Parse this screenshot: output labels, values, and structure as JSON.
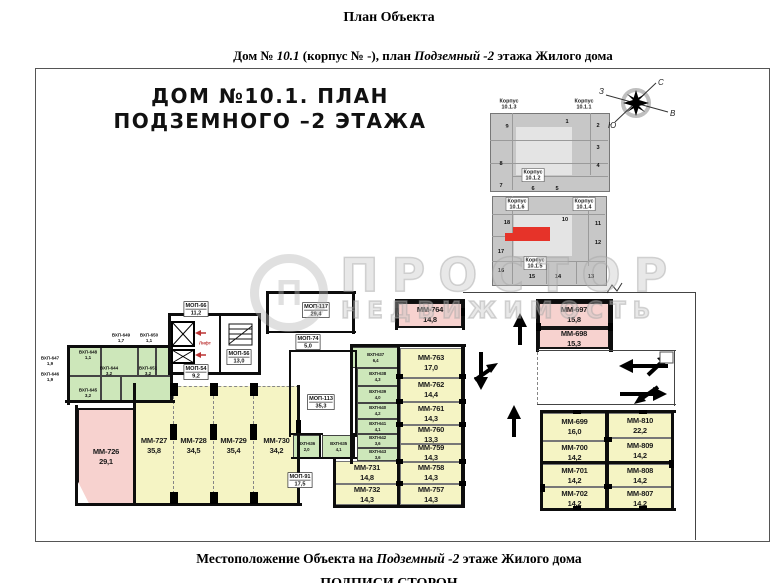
{
  "page": {
    "title": "План Объекта",
    "subtitle_parts": [
      {
        "t": "Дом № ",
        "i": false
      },
      {
        "t": "10.1",
        "i": true
      },
      {
        "t": " (корпус № -), план ",
        "i": false
      },
      {
        "t": "Подземный -2",
        "i": true
      },
      {
        "t": " этажа Жилого дома",
        "i": false
      }
    ],
    "footer_parts": [
      {
        "t": "Местоположение Объекта на  ",
        "i": false
      },
      {
        "t": "Подземный -2",
        "i": true
      },
      {
        "t": " этаже Жилого дома",
        "i": false
      }
    ],
    "footer_signatures": "ПОДПИСИ СТОРОН"
  },
  "plan_title": {
    "line1": "ДОМ №10.1. ПЛАН",
    "line2": "ПОДЗЕМНОГО –2 ЭТАЖА"
  },
  "watermark": {
    "logo_letter": "П",
    "line1": "ПРОСТОР",
    "line2": "НЕДВИЖИМОСТЬ"
  },
  "compass": {
    "north": "С",
    "south": "Ю",
    "west": "З",
    "east": "В"
  },
  "lift": {
    "label": "Лифт",
    "color": "#b33"
  },
  "keyplan": {
    "highlight_color": "#e63329",
    "korpus_labels": [
      {
        "name": "Корпус",
        "num": "10.1.3",
        "x": 509,
        "y": 104,
        "boxed": false
      },
      {
        "name": "Корпус",
        "num": "10.1.1",
        "x": 584,
        "y": 104,
        "boxed": false
      },
      {
        "name": "Корпус",
        "num": "10.1.2",
        "x": 533,
        "y": 175,
        "boxed": true
      },
      {
        "name": "Корпус",
        "num": "10.1.6",
        "x": 517,
        "y": 204,
        "boxed": true
      },
      {
        "name": "Корпус",
        "num": "10.1.4",
        "x": 584,
        "y": 204,
        "boxed": true
      },
      {
        "name": "Корпус",
        "num": "10.1.5",
        "x": 535,
        "y": 263,
        "boxed": true
      }
    ],
    "sections": [
      {
        "n": "9",
        "x": 507,
        "y": 126
      },
      {
        "n": "1",
        "x": 567,
        "y": 121
      },
      {
        "n": "2",
        "x": 598,
        "y": 125
      },
      {
        "n": "3",
        "x": 598,
        "y": 147
      },
      {
        "n": "8",
        "x": 501,
        "y": 163
      },
      {
        "n": "4",
        "x": 598,
        "y": 165
      },
      {
        "n": "7",
        "x": 501,
        "y": 185
      },
      {
        "n": "6",
        "x": 533,
        "y": 188
      },
      {
        "n": "5",
        "x": 557,
        "y": 188
      },
      {
        "n": "18",
        "x": 507,
        "y": 222
      },
      {
        "n": "10",
        "x": 565,
        "y": 219
      },
      {
        "n": "11",
        "x": 598,
        "y": 223
      },
      {
        "n": "12",
        "x": 598,
        "y": 242
      },
      {
        "n": "17",
        "x": 501,
        "y": 251
      },
      {
        "n": "16",
        "x": 501,
        "y": 270
      },
      {
        "n": "15",
        "x": 532,
        "y": 276
      },
      {
        "n": "14",
        "x": 558,
        "y": 276
      },
      {
        "n": "13",
        "x": 591,
        "y": 276
      }
    ]
  },
  "rooms": [
    {
      "id": "ММ-726",
      "area": "29,1",
      "type": "pink",
      "x": 77,
      "y": 408,
      "w": 58,
      "h": 97,
      "clip": true
    },
    {
      "id": "ММ-727",
      "area": "35,8",
      "type": "yellow",
      "x": 135,
      "y": 386,
      "w": 38,
      "h": 118,
      "bay": true
    },
    {
      "id": "ММ-728",
      "area": "34,5",
      "type": "yellow",
      "x": 173,
      "y": 386,
      "w": 40,
      "h": 118,
      "bay": true,
      "dashLeft": true
    },
    {
      "id": "ММ-729",
      "area": "35,4",
      "type": "yellow",
      "x": 213,
      "y": 386,
      "w": 40,
      "h": 118,
      "bay": true,
      "dashLeft": true
    },
    {
      "id": "ММ-730",
      "area": "34,2",
      "type": "yellow",
      "x": 253,
      "y": 386,
      "w": 46,
      "h": 118,
      "bay": true,
      "dashLeft": true
    },
    {
      "id": "ММ-731",
      "area": "14,8",
      "type": "yellow",
      "x": 335,
      "y": 461,
      "w": 64,
      "h": 23
    },
    {
      "id": "ММ-732",
      "area": "14,3",
      "type": "yellow",
      "x": 335,
      "y": 484,
      "w": 64,
      "h": 21
    },
    {
      "id": "ММ-763",
      "area": "17,0",
      "type": "yellow",
      "x": 400,
      "y": 348,
      "w": 62,
      "h": 30
    },
    {
      "id": "ММ-762",
      "area": "14,4",
      "type": "yellow",
      "x": 400,
      "y": 378,
      "w": 62,
      "h": 24
    },
    {
      "id": "ММ-761",
      "area": "14,3",
      "type": "yellow",
      "x": 400,
      "y": 402,
      "w": 62,
      "h": 23
    },
    {
      "id": "ММ-760",
      "area": "13,3",
      "type": "yellow",
      "x": 400,
      "y": 425,
      "w": 62,
      "h": 19
    },
    {
      "id": "ММ-759",
      "area": "14,3",
      "type": "yellow",
      "x": 400,
      "y": 444,
      "w": 62,
      "h": 18
    },
    {
      "id": "ММ-758",
      "area": "14,3",
      "type": "yellow",
      "x": 400,
      "y": 462,
      "w": 62,
      "h": 22
    },
    {
      "id": "ММ-757",
      "area": "14,3",
      "type": "yellow",
      "x": 400,
      "y": 484,
      "w": 62,
      "h": 21
    },
    {
      "id": "ММ-764",
      "area": "14,8",
      "type": "pink",
      "x": 397,
      "y": 302,
      "w": 66,
      "h": 26
    },
    {
      "id": "ММ-697",
      "area": "15,8",
      "type": "pink",
      "x": 538,
      "y": 302,
      "w": 72,
      "h": 26
    },
    {
      "id": "ММ-698",
      "area": "15,3",
      "type": "pink",
      "x": 538,
      "y": 328,
      "w": 72,
      "h": 21
    },
    {
      "id": "ММ-699",
      "area": "16,0",
      "type": "yellow",
      "x": 542,
      "y": 413,
      "w": 65,
      "h": 28
    },
    {
      "id": "ММ-700",
      "area": "14,2",
      "type": "yellow",
      "x": 542,
      "y": 441,
      "w": 65,
      "h": 23
    },
    {
      "id": "ММ-701",
      "area": "14,2",
      "type": "yellow",
      "x": 542,
      "y": 464,
      "w": 65,
      "h": 23
    },
    {
      "id": "ММ-702",
      "area": "14,2",
      "type": "yellow",
      "x": 542,
      "y": 487,
      "w": 65,
      "h": 23
    },
    {
      "id": "ММ-810",
      "area": "22,2",
      "type": "yellow",
      "x": 607,
      "y": 413,
      "w": 66,
      "h": 25
    },
    {
      "id": "ММ-809",
      "area": "14,2",
      "type": "yellow",
      "x": 607,
      "y": 438,
      "w": 66,
      "h": 26
    },
    {
      "id": "ММ-808",
      "area": "14,2",
      "type": "yellow",
      "x": 607,
      "y": 464,
      "w": 66,
      "h": 23
    },
    {
      "id": "ММ-807",
      "area": "14,2",
      "type": "yellow",
      "x": 607,
      "y": 487,
      "w": 66,
      "h": 23
    },
    {
      "id": "ВХП-637",
      "area": "6,4",
      "type": "green",
      "x": 352,
      "y": 347,
      "w": 47,
      "h": 21,
      "small": true
    },
    {
      "id": "ВХП-638",
      "area": "4,3",
      "type": "green",
      "x": 357,
      "y": 368,
      "w": 42,
      "h": 18,
      "small": true
    },
    {
      "id": "ВХП-639",
      "area": "4,0",
      "type": "green",
      "x": 357,
      "y": 386,
      "w": 42,
      "h": 17,
      "small": true
    },
    {
      "id": "ВХП-640",
      "area": "4,2",
      "type": "green",
      "x": 357,
      "y": 403,
      "w": 42,
      "h": 16,
      "small": true
    },
    {
      "id": "ВХП-641",
      "area": "4,1",
      "type": "green",
      "x": 357,
      "y": 419,
      "w": 42,
      "h": 15,
      "small": true
    },
    {
      "id": "ВХП-642",
      "area": "3,6",
      "type": "green",
      "x": 357,
      "y": 434,
      "w": 42,
      "h": 14,
      "small": true
    },
    {
      "id": "ВХП-643",
      "area": "3,6",
      "type": "green",
      "x": 357,
      "y": 448,
      "w": 42,
      "h": 13,
      "small": true
    },
    {
      "id": "ВХП-636",
      "area": "2,0",
      "type": "green",
      "x": 293,
      "y": 435,
      "w": 28,
      "h": 24,
      "small": true
    },
    {
      "id": "ВХП-635",
      "area": "4,1",
      "type": "green",
      "x": 322,
      "y": 435,
      "w": 33,
      "h": 24,
      "small": true
    }
  ],
  "cluster_labels": [
    {
      "id": "ВХП-649",
      "area": "1,7",
      "x": 121,
      "y": 338
    },
    {
      "id": "ВХП-650",
      "area": "1,1",
      "x": 149,
      "y": 338
    },
    {
      "id": "ВХП-648",
      "area": "1,1",
      "x": 88,
      "y": 355
    },
    {
      "id": "ВХП-647",
      "area": "1,9",
      "x": 50,
      "y": 361
    },
    {
      "id": "ВХП-646",
      "area": "1,9",
      "x": 50,
      "y": 377
    },
    {
      "id": "ВХП-644",
      "area": "3,2",
      "x": 109,
      "y": 371
    },
    {
      "id": "ВХП-651",
      "area": "3,2",
      "x": 148,
      "y": 371
    },
    {
      "id": "ВХП-645",
      "area": "3,2",
      "x": 88,
      "y": 393
    }
  ],
  "mop_labels": [
    {
      "id": "МОП-66",
      "area": "11,2",
      "x": 196,
      "y": 309
    },
    {
      "id": "МОП-117",
      "area": "29,4",
      "x": 316,
      "y": 310
    },
    {
      "id": "МОП-56",
      "area": "13,0",
      "x": 239,
      "y": 357
    },
    {
      "id": "МОП-54",
      "area": "9,2",
      "x": 196,
      "y": 372
    },
    {
      "id": "МОП-74",
      "area": "5,0",
      "x": 308,
      "y": 342
    },
    {
      "id": "МОП-113",
      "area": "35,3",
      "x": 321,
      "y": 402
    },
    {
      "id": "МОП-91",
      "area": "17,5",
      "x": 300,
      "y": 480
    }
  ]
}
